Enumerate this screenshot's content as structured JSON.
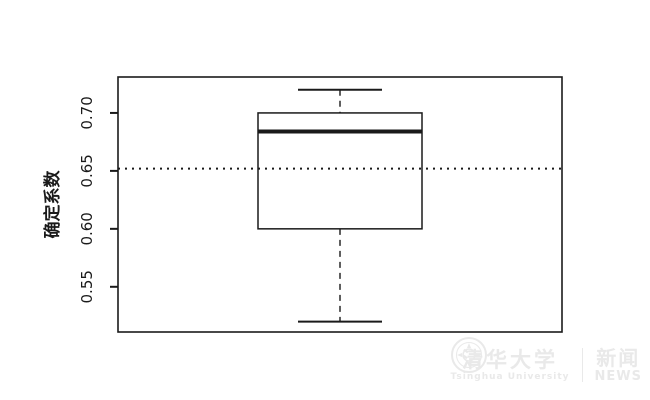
{
  "chart_data": {
    "type": "boxplot",
    "title": "",
    "xlabel": "",
    "ylabel": "确定系数",
    "ylim": [
      0.511,
      0.731
    ],
    "ytick_values": [
      0.55,
      0.6,
      0.65,
      0.7
    ],
    "ytick_labels": [
      "0.55",
      "0.60",
      "0.65",
      "0.70"
    ],
    "grid": false,
    "legend": null,
    "series": [
      {
        "name": "确定系数-boxplot",
        "whisker_low": 0.52,
        "q1": 0.6,
        "median": 0.684,
        "q3": 0.7,
        "whisker_high": 0.72,
        "outliers": []
      }
    ],
    "reference_line": {
      "value": 0.652,
      "style": "dotted"
    },
    "line_color": "#1a1a1a",
    "background": "#ffffff"
  },
  "watermark": {
    "university_cn": "清华大学",
    "university_en": "Tsinghua University",
    "separator": "",
    "news_cn": "新闻",
    "news_en": "NEWS",
    "color": "#e9e9e9"
  }
}
